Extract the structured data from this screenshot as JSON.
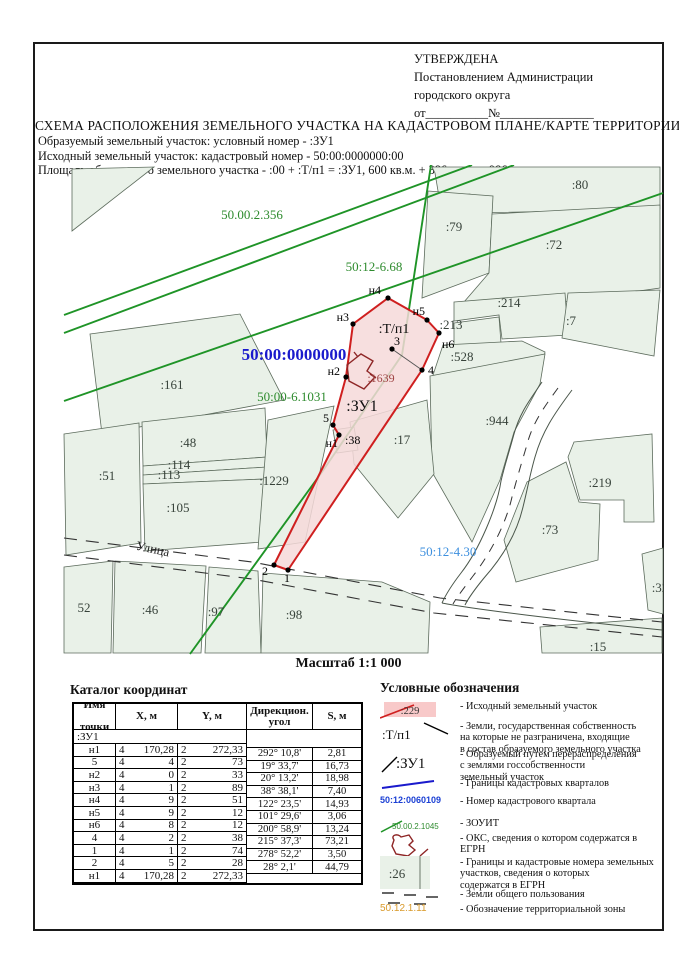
{
  "approval": {
    "line1": "УТВЕРЖДЕНА",
    "line2": "Постановлением Администрации",
    "line3": "городского округа",
    "line4": "от__________№_______________"
  },
  "title": "СХЕМА РАСПОЛОЖЕНИЯ ЗЕМЕЛЬНОГО УЧАСТКА НА КАДАСТРОВОМ ПЛАНЕ/КАРТЕ ТЕРРИТОРИИ",
  "subtitle_lines": [
    "Образуемый земельный участок: условный номер - :ЗУ1",
    "Исходный земельный участок:  кадастровый номер - 50:00:0000000:00",
    "Площадь образуемого земельного участка -  :00 + :Т/п1 = :ЗУ1,  600 кв.м. + 386 кв.м. = 986 кв.м."
  ],
  "map": {
    "scale_label": "Масштаб 1:1 000",
    "street_label": "Улица",
    "zone_labels": [
      {
        "t": "50.00.2.356",
        "x": 250,
        "y": 217,
        "c": "#2e8b2e",
        "s": 13,
        "b": false
      },
      {
        "t": "50:12-6.68",
        "x": 372,
        "y": 269,
        "c": "#2e8b2e",
        "s": 13,
        "b": false
      },
      {
        "t": "50:00:0000000",
        "x": 292,
        "y": 358,
        "c": "#1a1acc",
        "s": 17,
        "b": true
      },
      {
        "t": "50:00-6.1031",
        "x": 290,
        "y": 399,
        "c": "#2e8b2e",
        "s": 13,
        "b": false
      },
      {
        "t": "50:12-4.30",
        "x": 446,
        "y": 554,
        "c": "#3d8fde",
        "s": 13,
        "b": false
      }
    ],
    "unit_labels": [
      {
        "t": ":Т/п1",
        "x": 392,
        "y": 331,
        "c": "#111",
        "s": 14
      },
      {
        "t": ":ЗУ1",
        "x": 360,
        "y": 409,
        "c": "#111",
        "s": 16
      },
      {
        "t": ":1639",
        "x": 379,
        "y": 380,
        "c": "#9e4444",
        "s": 12
      }
    ],
    "parcel_labels": [
      {
        "t": ":80",
        "x": 578,
        "y": 187
      },
      {
        "t": ":79",
        "x": 452,
        "y": 229
      },
      {
        "t": ":72",
        "x": 552,
        "y": 247
      },
      {
        "t": ":214",
        "x": 507,
        "y": 305
      },
      {
        "t": ":213",
        "x": 449,
        "y": 327
      },
      {
        "t": ":7",
        "x": 569,
        "y": 323
      },
      {
        "t": ":528",
        "x": 460,
        "y": 359
      },
      {
        "t": ":944",
        "x": 495,
        "y": 423
      },
      {
        "t": ":161",
        "x": 170,
        "y": 387
      },
      {
        "t": ":48",
        "x": 186,
        "y": 445
      },
      {
        "t": ":114",
        "x": 177,
        "y": 467
      },
      {
        "t": ":113",
        "x": 167,
        "y": 477
      },
      {
        "t": ":51",
        "x": 105,
        "y": 478
      },
      {
        "t": ":105",
        "x": 176,
        "y": 510
      },
      {
        "t": ":1229",
        "x": 272,
        "y": 483
      },
      {
        "t": ":17",
        "x": 400,
        "y": 442
      },
      {
        "t": ":219",
        "x": 598,
        "y": 485
      },
      {
        "t": ":73",
        "x": 548,
        "y": 532
      },
      {
        "t": ":32",
        "x": 658,
        "y": 590
      },
      {
        "t": ":15",
        "x": 596,
        "y": 649
      },
      {
        "t": "52",
        "x": 82,
        "y": 610
      },
      {
        "t": ":46",
        "x": 148,
        "y": 612
      },
      {
        "t": ":97",
        "x": 214,
        "y": 614
      },
      {
        "t": ":98",
        "x": 292,
        "y": 617
      }
    ],
    "point_labels": [
      {
        "t": "н4",
        "x": 379,
        "y": 292,
        "a": "end"
      },
      {
        "t": "н3",
        "x": 347,
        "y": 319,
        "a": "end"
      },
      {
        "t": "н5",
        "x": 423,
        "y": 313,
        "a": "end"
      },
      {
        "t": "н6",
        "x": 440,
        "y": 346,
        "a": "start"
      },
      {
        "t": "3",
        "x": 392,
        "y": 343,
        "a": "start"
      },
      {
        "t": "н2",
        "x": 338,
        "y": 373,
        "a": "end"
      },
      {
        "t": "4",
        "x": 426,
        "y": 372,
        "a": "start"
      },
      {
        "t": "5",
        "x": 327,
        "y": 420,
        "a": "end"
      },
      {
        "t": "н1",
        "x": 336,
        "y": 445,
        "a": "end"
      },
      {
        "t": ":38",
        "x": 343,
        "y": 442,
        "a": "start"
      },
      {
        "t": "2",
        "x": 263,
        "y": 573,
        "a": "middle"
      },
      {
        "t": "1",
        "x": 285,
        "y": 580,
        "a": "middle"
      }
    ]
  },
  "catalog": {
    "title": "Каталог координат",
    "headers": {
      "name1": "Имя",
      "name2": "точки",
      "x": "X, м",
      "y": "Y, м",
      "a1": "Дирекцион.",
      "a2": "угол",
      "s": "S, м"
    },
    "group": ":ЗУ1",
    "points": [
      {
        "name": "н1",
        "xp": "4",
        "xs": "170,28",
        "yp": "2",
        "ys": "272,33"
      },
      {
        "name": "5",
        "xp": "4",
        "xs": "4",
        "yp": "2",
        "ys": "73"
      },
      {
        "name": "н2",
        "xp": "4",
        "xs": "0",
        "yp": "2",
        "ys": "33"
      },
      {
        "name": "н3",
        "xp": "4",
        "xs": "1",
        "yp": "2",
        "ys": "89"
      },
      {
        "name": "н4",
        "xp": "4",
        "xs": "9",
        "yp": "2",
        "ys": "51"
      },
      {
        "name": "н5",
        "xp": "4",
        "xs": "9",
        "yp": "2",
        "ys": "12"
      },
      {
        "name": "н6",
        "xp": "4",
        "xs": "8",
        "yp": "2",
        "ys": "12"
      },
      {
        "name": "4",
        "xp": "4",
        "xs": "2",
        "yp": "2",
        "ys": "38"
      },
      {
        "name": "1",
        "xp": "4",
        "xs": "1",
        "yp": "2",
        "ys": "74"
      },
      {
        "name": "2",
        "xp": "4",
        "xs": "5",
        "yp": "2",
        "ys": "28"
      },
      {
        "name": "н1",
        "xp": "4",
        "xs": "170,28",
        "yp": "2",
        "ys": "272,33"
      }
    ],
    "segments": [
      {
        "a": "292° 10,8'",
        "s": "2,81"
      },
      {
        "a": "19° 33,7'",
        "s": "16,73"
      },
      {
        "a": "20° 13,2'",
        "s": "18,98"
      },
      {
        "a": "38° 38,1'",
        "s": "7,40"
      },
      {
        "a": "122° 23,5'",
        "s": "14,93"
      },
      {
        "a": "101° 29,6'",
        "s": "3,06"
      },
      {
        "a": "200° 58,9'",
        "s": "13,24"
      },
      {
        "a": "215° 37,3'",
        "s": "73,21"
      },
      {
        "a": "278° 52,2'",
        "s": "3,50"
      },
      {
        "a": "28° 2,1'",
        "s": "44,79"
      }
    ]
  },
  "legend": {
    "title": "Условные обозначения",
    "items": [
      {
        "type": "pink",
        "sample": ":229",
        "lines": [
          "- Исходный земельный участок"
        ]
      },
      {
        "type": "tpn",
        "sample": ":Т/п1",
        "lines": [
          "- Земли, государственная собственность",
          "на которые не разграничена, входящие",
          "в состав образуемого земельного участка"
        ]
      },
      {
        "type": "zu1",
        "sample": ":ЗУ1",
        "lines": [
          "- Образуемый путем перераспределения",
          "с землями госсобственности",
          "земельный участок"
        ]
      },
      {
        "type": "blueline",
        "sample": "",
        "lines": [
          "- Границы кадастровых кварталов"
        ]
      },
      {
        "type": "bluetext",
        "sample": "50:12:0060109",
        "lines": [
          "- Номер кадастрового квартала"
        ]
      },
      {
        "type": "greenline",
        "sample": "50.00.2.1045",
        "lines": [
          "- ЗОУИТ"
        ]
      },
      {
        "type": "oks",
        "sample": "",
        "lines": [
          "- ОКС, сведения о котором содержатся в ЕГРН"
        ]
      },
      {
        "type": "greenparcel",
        "sample": ":26",
        "lines": [
          "- Границы и кадастровые номера земельных",
          "участков, сведения о которых",
          "содержатся в ЕГРН"
        ]
      },
      {
        "type": "dashes",
        "sample": "",
        "lines": [
          "- Земли общего пользования"
        ]
      },
      {
        "type": "orangetext",
        "sample": "50.12.1.11",
        "lines": [
          "- Обозначение территориальной зоны"
        ]
      }
    ]
  },
  "colors": {
    "red_boundary": "#cf1f1f",
    "pink_fill": "#f6d9d9",
    "pink_swatch": "#f8c9c9",
    "green_line": "#1f9427",
    "green_text": "#2e8b2e",
    "blue": "#1a1acc",
    "light_blue": "#3d8fde",
    "orange": "#d99a2b",
    "dark_red": "#8e2626",
    "parcel_fill": "#e9f1e8",
    "parcel_stroke": "#5c6b5c"
  }
}
